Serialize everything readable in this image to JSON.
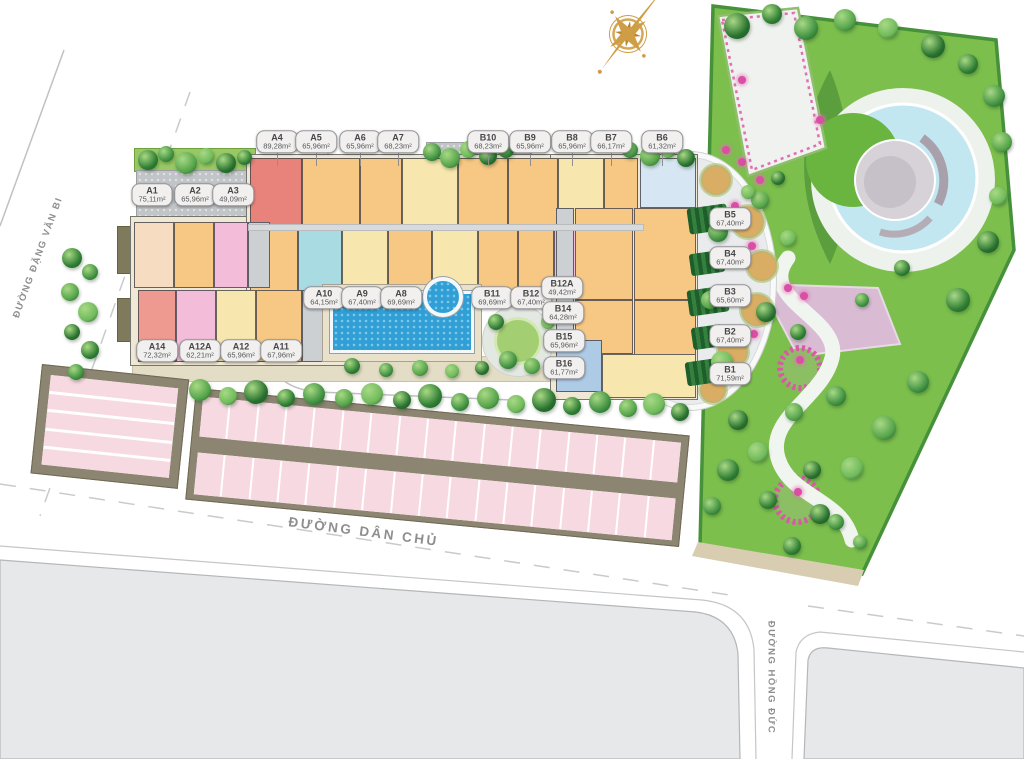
{
  "streets": {
    "left": "ĐƯỜNG ĐẶNG VĂN BI",
    "bottom": "ĐƯỜNG DÂN CHỦ",
    "right": "ĐƯỜNG HỒNG ĐỨC"
  },
  "compass": {
    "name": "compass-rose",
    "color": "#cf9d45"
  },
  "unit_labels": [
    {
      "id": "A4",
      "area": "89,28m²",
      "x": 277,
      "y": 142,
      "s": 1
    },
    {
      "id": "A5",
      "area": "65,96m²",
      "x": 316,
      "y": 142,
      "s": 1
    },
    {
      "id": "A6",
      "area": "65,96m²",
      "x": 360,
      "y": 142,
      "s": 1
    },
    {
      "id": "A7",
      "area": "68,23m²",
      "x": 398,
      "y": 142,
      "s": 1
    },
    {
      "id": "B10",
      "area": "68,23m²",
      "x": 488,
      "y": 142,
      "s": 1
    },
    {
      "id": "B9",
      "area": "65,96m²",
      "x": 530,
      "y": 142,
      "s": 1
    },
    {
      "id": "B8",
      "area": "65,96m²",
      "x": 572,
      "y": 142,
      "s": 1
    },
    {
      "id": "B7",
      "area": "66,17m²",
      "x": 611,
      "y": 142,
      "s": 1
    },
    {
      "id": "B6",
      "area": "61,32m²",
      "x": 662,
      "y": 142,
      "s": 1
    },
    {
      "id": "A1",
      "area": "75,11m²",
      "x": 152,
      "y": 195,
      "s": 0
    },
    {
      "id": "A2",
      "area": "65,96m²",
      "x": 195,
      "y": 195,
      "s": 0
    },
    {
      "id": "A3",
      "area": "49,09m²",
      "x": 233,
      "y": 195,
      "s": 0
    },
    {
      "id": "B5",
      "area": "67,40m²",
      "x": 730,
      "y": 219,
      "s": 0
    },
    {
      "id": "B4",
      "area": "67,40m²",
      "x": 730,
      "y": 258,
      "s": 0
    },
    {
      "id": "B3",
      "area": "65,60m²",
      "x": 730,
      "y": 296,
      "s": 0
    },
    {
      "id": "B2",
      "area": "67,40m²",
      "x": 730,
      "y": 336,
      "s": 0
    },
    {
      "id": "B1",
      "area": "71,59m²",
      "x": 730,
      "y": 374,
      "s": 0
    },
    {
      "id": "A10",
      "area": "64,15m²",
      "x": 324,
      "y": 298,
      "s": 0
    },
    {
      "id": "A9",
      "area": "67,40m²",
      "x": 362,
      "y": 298,
      "s": 0
    },
    {
      "id": "A8",
      "area": "69,69m²",
      "x": 401,
      "y": 298,
      "s": 0
    },
    {
      "id": "B11",
      "area": "69,69m²",
      "x": 492,
      "y": 298,
      "s": 0
    },
    {
      "id": "B12",
      "area": "67,40m²",
      "x": 531,
      "y": 298,
      "s": 0
    },
    {
      "id": "B12A",
      "area": "49,42m²",
      "x": 562,
      "y": 288,
      "s": 0
    },
    {
      "id": "B14",
      "area": "64,28m²",
      "x": 563,
      "y": 313,
      "s": 0
    },
    {
      "id": "B15",
      "area": "65,96m²",
      "x": 564,
      "y": 341,
      "s": 0
    },
    {
      "id": "B16",
      "area": "61,77m²",
      "x": 564,
      "y": 368,
      "s": 0
    },
    {
      "id": "A14",
      "area": "72,32m²",
      "x": 157,
      "y": 351,
      "s": 0
    },
    {
      "id": "A12A",
      "area": "62,21m²",
      "x": 200,
      "y": 351,
      "s": 0
    },
    {
      "id": "A12",
      "area": "65,96m²",
      "x": 241,
      "y": 351,
      "s": 0
    },
    {
      "id": "A11",
      "area": "67,96m²",
      "x": 281,
      "y": 351,
      "s": 0
    }
  ],
  "unit_colors": {
    "red": "#e8837c",
    "red2": "#ef9a90",
    "org": "#f7c784",
    "yel": "#f7e7af",
    "pnk": "#f3bcd9",
    "cyn": "#a9dbe2",
    "pch": "#f6dcc0",
    "gry": "#ccd0d3",
    "blu": "#aecbe6",
    "pbl": "#d6e7f3"
  },
  "building": {
    "slabs": [
      [
        130,
        216,
        226,
        150
      ],
      [
        246,
        154,
        400,
        148
      ],
      [
        550,
        154,
        148,
        246
      ]
    ],
    "units": [
      [
        250,
        158,
        52,
        68,
        "red"
      ],
      [
        302,
        158,
        58,
        68,
        "org"
      ],
      [
        360,
        158,
        42,
        68,
        "org"
      ],
      [
        402,
        158,
        56,
        68,
        "yel"
      ],
      [
        458,
        158,
        50,
        68,
        "org"
      ],
      [
        508,
        158,
        50,
        68,
        "org"
      ],
      [
        558,
        158,
        46,
        68,
        "yel"
      ],
      [
        604,
        158,
        34,
        68,
        "org"
      ],
      [
        640,
        158,
        56,
        50,
        "pbl"
      ],
      [
        250,
        230,
        48,
        66,
        "org"
      ],
      [
        298,
        230,
        44,
        66,
        "cyn"
      ],
      [
        342,
        230,
        46,
        66,
        "yel"
      ],
      [
        388,
        230,
        44,
        66,
        "org"
      ],
      [
        432,
        230,
        46,
        66,
        "yel"
      ],
      [
        478,
        230,
        40,
        66,
        "org"
      ],
      [
        518,
        230,
        36,
        66,
        "org"
      ],
      [
        554,
        224,
        28,
        74,
        "pnk"
      ],
      [
        134,
        222,
        40,
        66,
        "pch"
      ],
      [
        174,
        222,
        40,
        66,
        "org"
      ],
      [
        214,
        222,
        34,
        66,
        "pnk"
      ],
      [
        248,
        222,
        22,
        66,
        "gry"
      ],
      [
        138,
        290,
        38,
        72,
        "red2"
      ],
      [
        176,
        290,
        40,
        72,
        "pnk"
      ],
      [
        216,
        290,
        40,
        72,
        "yel"
      ],
      [
        256,
        290,
        46,
        72,
        "org"
      ],
      [
        302,
        290,
        34,
        72,
        "gry"
      ],
      [
        556,
        208,
        18,
        132,
        "gry"
      ],
      [
        575,
        208,
        58,
        92,
        "org"
      ],
      [
        634,
        208,
        62,
        92,
        "org"
      ],
      [
        575,
        300,
        58,
        54,
        "org"
      ],
      [
        634,
        300,
        62,
        96,
        "org"
      ],
      [
        556,
        340,
        46,
        52,
        "blu"
      ],
      [
        602,
        354,
        94,
        44,
        "yel"
      ]
    ]
  },
  "courtyard": {
    "sand": [
      [
        716,
        180,
        15
      ],
      [
        748,
        222,
        16
      ],
      [
        762,
        266,
        15
      ],
      [
        757,
        310,
        16
      ],
      [
        733,
        352,
        15
      ],
      [
        713,
        390,
        13
      ]
    ],
    "hedges": [
      [
        688,
        206,
        40,
        26
      ],
      [
        690,
        252,
        34,
        22
      ],
      [
        688,
        288,
        40,
        26
      ],
      [
        692,
        326,
        32,
        22
      ],
      [
        686,
        360,
        36,
        24
      ]
    ],
    "flowers": [
      [
        735,
        206
      ],
      [
        752,
        246
      ],
      [
        740,
        294
      ],
      [
        754,
        334
      ],
      [
        722,
        372
      ]
    ]
  },
  "garden_flowers": [
    [
      788,
      288
    ],
    [
      804,
      296
    ],
    [
      760,
      180
    ],
    [
      742,
      162
    ],
    [
      800,
      360
    ],
    [
      798,
      492
    ],
    [
      820,
      120
    ],
    [
      742,
      80
    ],
    [
      726,
      150
    ]
  ],
  "trees": [
    [
      148,
      160,
      20
    ],
    [
      166,
      154,
      16
    ],
    [
      186,
      163,
      22
    ],
    [
      206,
      156,
      16
    ],
    [
      226,
      163,
      20
    ],
    [
      244,
      157,
      15
    ],
    [
      432,
      152,
      18
    ],
    [
      450,
      158,
      20
    ],
    [
      468,
      149,
      17
    ],
    [
      488,
      156,
      18
    ],
    [
      506,
      150,
      16
    ],
    [
      630,
      150,
      16
    ],
    [
      650,
      156,
      20
    ],
    [
      668,
      150,
      16
    ],
    [
      686,
      158,
      18
    ],
    [
      72,
      258,
      20
    ],
    [
      90,
      272,
      16
    ],
    [
      70,
      292,
      18
    ],
    [
      88,
      312,
      20
    ],
    [
      72,
      332,
      16
    ],
    [
      90,
      350,
      18
    ],
    [
      76,
      372,
      16
    ],
    [
      200,
      390,
      22
    ],
    [
      228,
      396,
      18
    ],
    [
      256,
      392,
      24
    ],
    [
      286,
      398,
      18
    ],
    [
      314,
      394,
      22
    ],
    [
      344,
      398,
      18
    ],
    [
      372,
      394,
      22
    ],
    [
      402,
      400,
      18
    ],
    [
      430,
      396,
      24
    ],
    [
      460,
      402,
      18
    ],
    [
      488,
      398,
      22
    ],
    [
      516,
      404,
      18
    ],
    [
      544,
      400,
      24
    ],
    [
      572,
      406,
      18
    ],
    [
      600,
      402,
      22
    ],
    [
      628,
      408,
      18
    ],
    [
      654,
      404,
      22
    ],
    [
      680,
      412,
      18
    ],
    [
      352,
      366,
      16
    ],
    [
      386,
      370,
      14
    ],
    [
      420,
      368,
      16
    ],
    [
      452,
      371,
      14
    ],
    [
      482,
      368,
      14
    ],
    [
      496,
      322,
      16
    ],
    [
      508,
      360,
      18
    ],
    [
      532,
      366,
      16
    ],
    [
      548,
      322,
      14
    ],
    [
      737,
      26,
      26
    ],
    [
      772,
      14,
      20
    ],
    [
      806,
      28,
      24
    ],
    [
      845,
      20,
      22
    ],
    [
      888,
      28,
      20
    ],
    [
      933,
      46,
      24
    ],
    [
      968,
      64,
      20
    ],
    [
      994,
      96,
      22
    ],
    [
      1002,
      142,
      20
    ],
    [
      998,
      196,
      18
    ],
    [
      988,
      242,
      22
    ],
    [
      958,
      300,
      24
    ],
    [
      918,
      382,
      22
    ],
    [
      884,
      428,
      24
    ],
    [
      852,
      468,
      22
    ],
    [
      820,
      514,
      20
    ],
    [
      792,
      546,
      18
    ],
    [
      718,
      232,
      20
    ],
    [
      710,
      300,
      18
    ],
    [
      722,
      362,
      22
    ],
    [
      738,
      420,
      20
    ],
    [
      728,
      470,
      22
    ],
    [
      712,
      506,
      18
    ],
    [
      760,
      200,
      18
    ],
    [
      788,
      238,
      16
    ],
    [
      766,
      312,
      20
    ],
    [
      798,
      332,
      16
    ],
    [
      836,
      396,
      20
    ],
    [
      794,
      412,
      18
    ],
    [
      758,
      452,
      20
    ],
    [
      812,
      470,
      18
    ],
    [
      768,
      500,
      18
    ],
    [
      836,
      522,
      16
    ],
    [
      860,
      542,
      14
    ],
    [
      748,
      192,
      14
    ],
    [
      778,
      178,
      14
    ],
    [
      902,
      268,
      16
    ],
    [
      862,
      300,
      14
    ]
  ],
  "tree_palette": [
    "#2e7d33",
    "#3f9141",
    "#55a44a",
    "#6fba5b",
    "#27702e"
  ],
  "parking": {
    "left_rows": 5,
    "right_stalls": 17
  }
}
